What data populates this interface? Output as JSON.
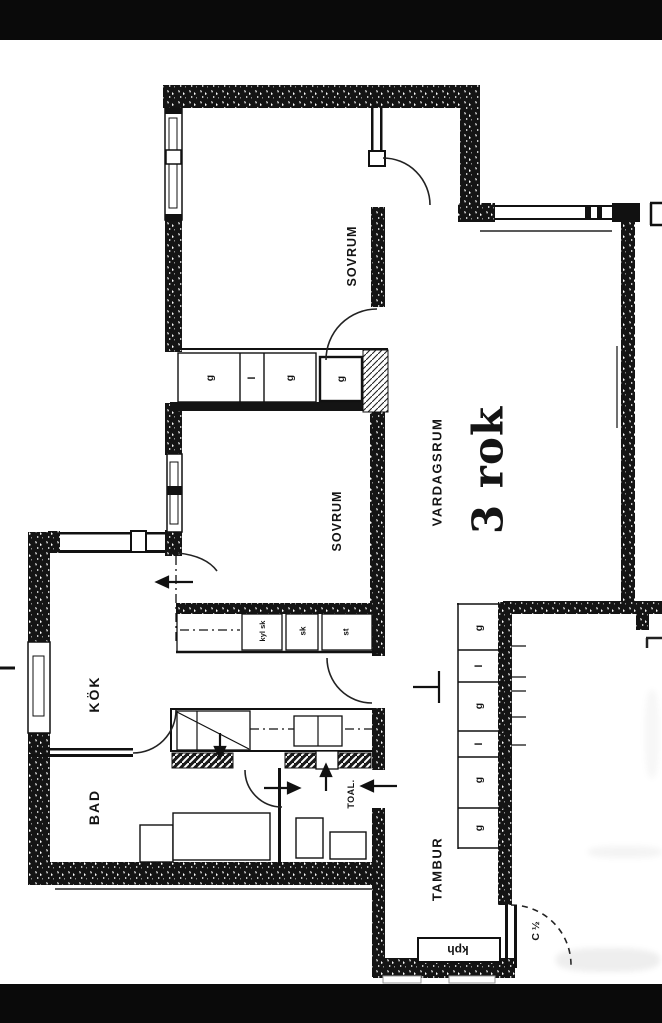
{
  "floor_plan": {
    "apartment_size": "3 rok",
    "rooms": {
      "sovrum_1": "SOVRUM",
      "sovrum_2": "SOVRUM",
      "vardagsrum": "VARDAGSRUM",
      "kok": "KÖK",
      "bad": "BAD",
      "toal": "TOAL.",
      "tambur": "TAMBUR"
    },
    "entry_door_mark": "C ½",
    "coat_rack": "kph",
    "bedroom_closets": [
      "g",
      "l",
      "g",
      "g"
    ],
    "hall_closets": [
      "g",
      "l",
      "g",
      "l",
      "g",
      "g"
    ],
    "kitchen_units": {
      "fridge_cabinet": "kyl sk",
      "cabinet": "sk",
      "cleaning_cabinet": "st"
    }
  }
}
